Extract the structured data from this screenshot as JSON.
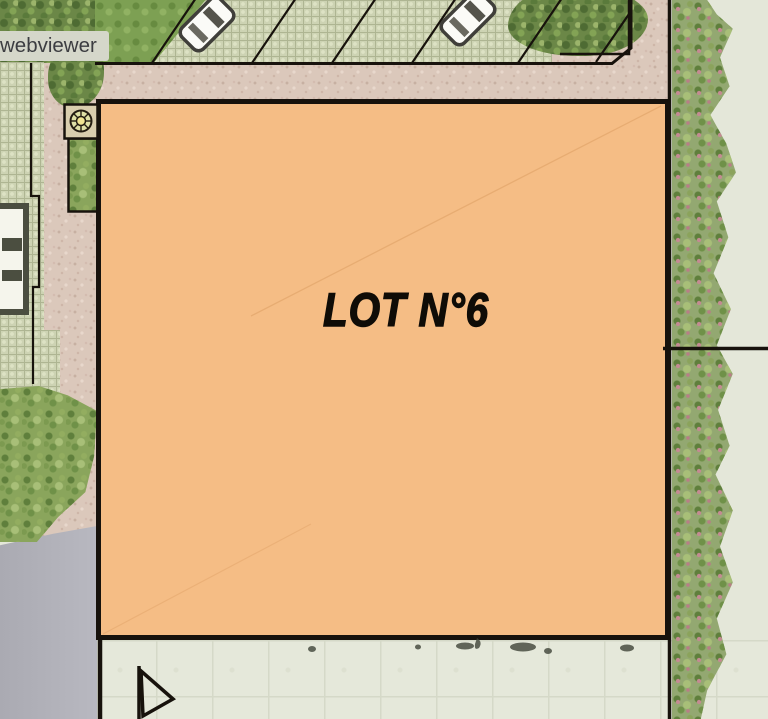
{
  "viewer": {
    "badge_label": "webviewer"
  },
  "site_plan": {
    "lot_label": "LOT N°6",
    "colors": {
      "lot_fill": "#F5BD85",
      "lot_border": "#17120C",
      "footpath_pink": "#DBC8BB",
      "parking_pavers": "#CDD3B3",
      "vegetation_green": "#7E9C52",
      "road_gray": "#B1B1B9",
      "concrete_pale": "#E5E8DA",
      "badge_bg": "#D5D7CA",
      "badge_text": "#3C3D41"
    },
    "symbols": {
      "parked_cars_visible": 2,
      "tree_marker": "flower-symbol-icon",
      "direction_marker": "arrow-icon"
    }
  }
}
